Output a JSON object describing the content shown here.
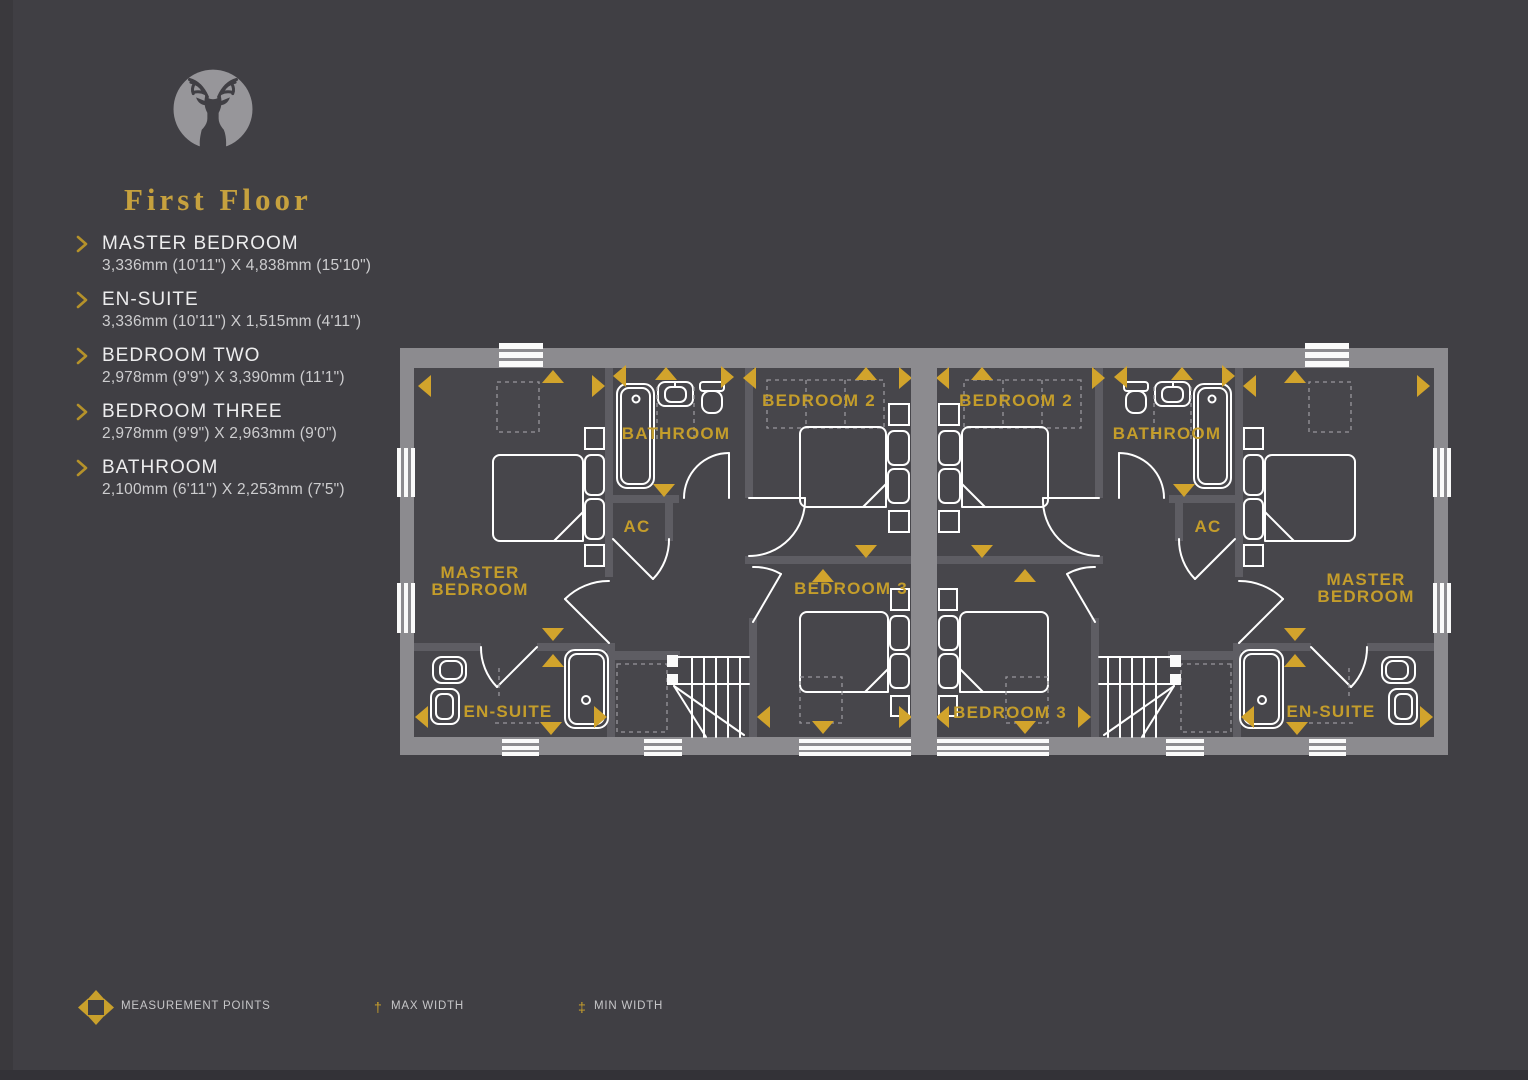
{
  "brand": {
    "title": "First Floor",
    "logo_name": "stag-logo"
  },
  "rooms": [
    {
      "name": "MASTER BEDROOM",
      "dimensions": "3,336mm (10'11\") X 4,838mm (15'10\")"
    },
    {
      "name": "EN-SUITE",
      "dimensions": "3,336mm (10'11\") X 1,515mm (4'11\")"
    },
    {
      "name": "BEDROOM TWO",
      "dimensions": "2,978mm (9'9\") X 3,390mm (11'1\")"
    },
    {
      "name": "BEDROOM THREE",
      "dimensions": "2,978mm (9'9\") X 2,963mm (9'0\")"
    },
    {
      "name": "BATHROOM",
      "dimensions": "2,100mm (6'11\") X 2,253mm (7'5\")"
    }
  ],
  "plan": {
    "left": {
      "master1": "MASTER",
      "master2": "BEDROOM",
      "bathroom": "BATHROOM",
      "ac": "AC",
      "bedroom2": "BEDROOM 2",
      "bedroom3": "BEDROOM 3",
      "ensuite": "EN-SUITE"
    },
    "right": {
      "master1": "MASTER",
      "master2": "BEDROOM",
      "bathroom": "BATHROOM",
      "ac": "AC",
      "bedroom2": "BEDROOM 2",
      "bedroom3": "BEDROOM 3",
      "ensuite": "EN-SUITE"
    }
  },
  "legend": {
    "measurement_points": "MEASUREMENT POINTS",
    "max_width_symbol": "†",
    "max_width": "MAX WIDTH",
    "min_width_symbol": "‡",
    "min_width": "MIN WIDTH"
  },
  "colors": {
    "background": "#403F44",
    "floor": "#47464B",
    "outer_wall": "#8C8B8F",
    "partition": "#5E5D63",
    "gold": "#C49D2B",
    "arrow_gold": "#D2A42C",
    "text": "#EDEDEE",
    "dim_text": "#CDCDCF"
  }
}
